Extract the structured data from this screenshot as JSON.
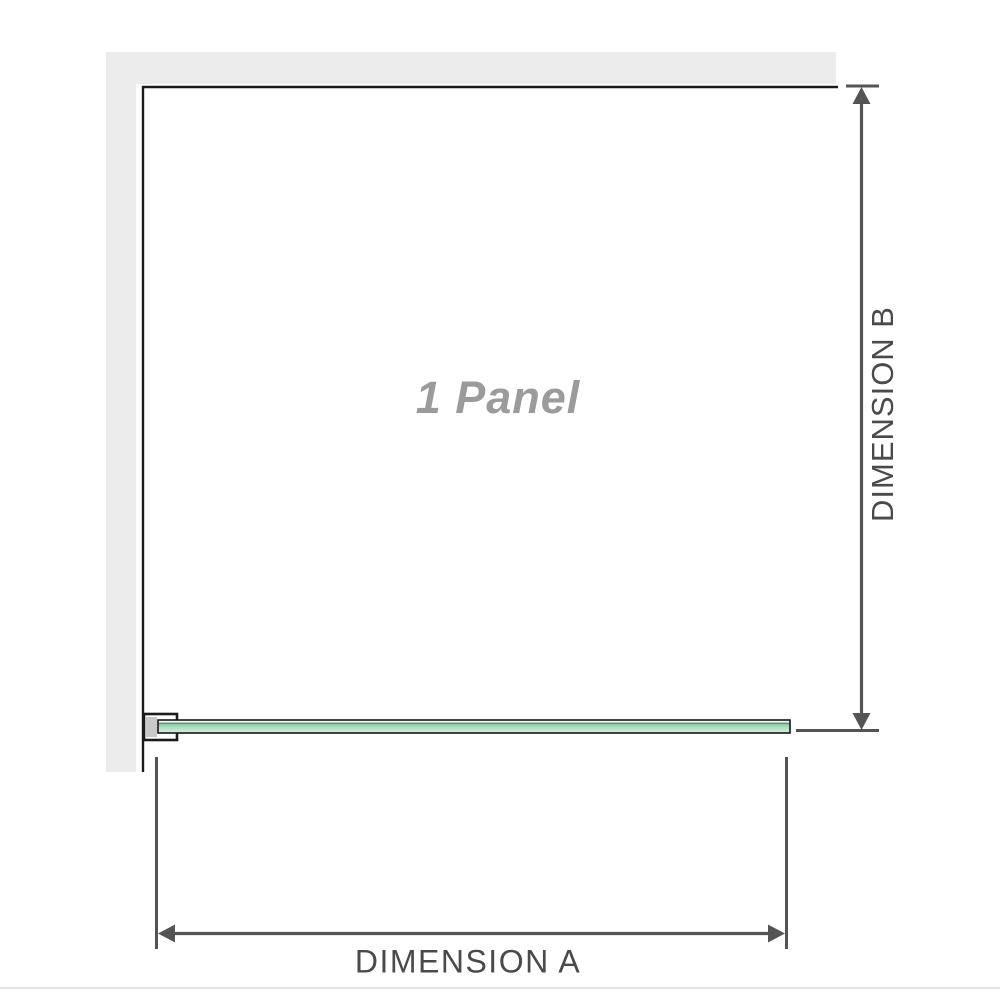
{
  "diagram": {
    "panel_label": "1 Panel",
    "dimension_a_label": "DIMENSION A",
    "dimension_b_label": "DIMENSION B",
    "colors": {
      "background": "#ffffff",
      "wall_fill": "#ececec",
      "panel_outline": "#1b1b1b",
      "dimension_lines": "#545454",
      "dimension_label_text": "#4a4a4a",
      "panel_label_text": "#9b9b9b",
      "glass_border": "#161616",
      "glass_green_highlight": "#f4faf5",
      "glass_green_dark_line": "#5a7a64",
      "glass_green_mid": "#a6d9ba",
      "glass_green_light": "#d4efdb",
      "bracket_fill": "#ffffff",
      "bracket_pad_fill": "#c9c9c9",
      "footer_rule": "#e3e3e1"
    }
  }
}
